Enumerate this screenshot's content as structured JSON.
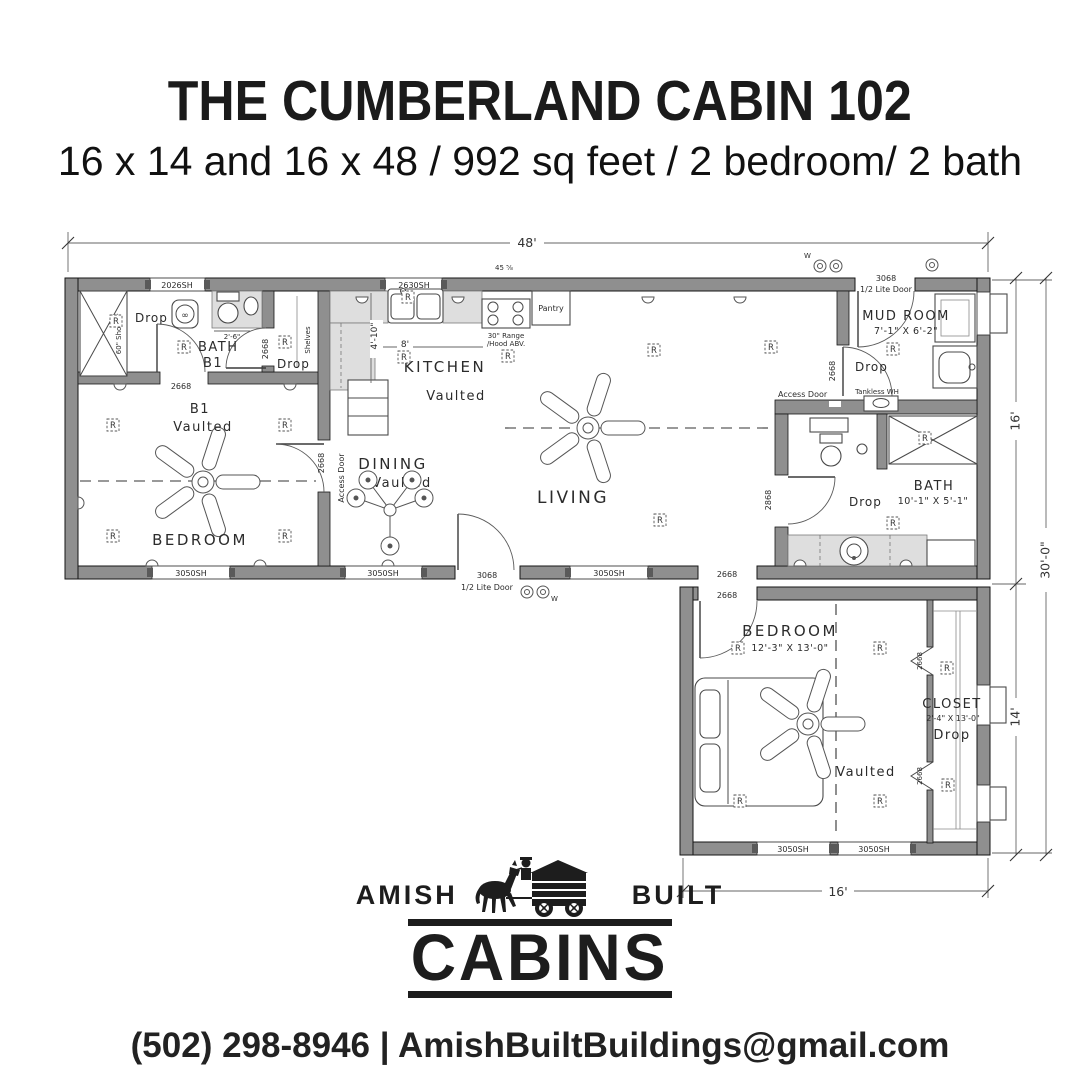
{
  "header": {
    "title": "THE CUMBERLAND CABIN 102",
    "subtitle": "16 x 14 and 16 x 48 / 992 sq feet / 2 bedroom/ 2 bath"
  },
  "logo": {
    "amish": "AMISH",
    "built": "BUILT",
    "cabins": "CABINS"
  },
  "footer": {
    "contact": "(502) 298-8946 | AmishBuiltBuildings@gmail.com"
  },
  "plan": {
    "dims": {
      "top": "48'",
      "right_upper": "16'",
      "right_overall": "30'-0\"",
      "right_lower": "14'",
      "bottom": "16'",
      "kitchen_width": "8'",
      "kitchen_depth": "4'-10\"",
      "bath1_vanity": "2'-6\"",
      "tiny": "45 ⅝"
    },
    "rooms": {
      "bath1": "BATH",
      "bath1_sub": "B1",
      "bed1": "B1",
      "bed1_sub": "Vaulted",
      "bed1_name": "BEDROOM",
      "kitchen": "KITCHEN",
      "kitchen_sub": "Vaulted",
      "dining": "DINING",
      "dining_sub": "Vaulted",
      "living": "LIVING",
      "mudroom": "MUD ROOM",
      "mudroom_size": "7'-1\" X 6'-2\"",
      "bath2": "BATH",
      "bath2_size": "10'-1\" X 5'-1\"",
      "bed2": "BEDROOM",
      "bed2_size": "12'-3\" X 13'-0\"",
      "bed2_sub": "Vaulted",
      "closet": "CLOSET",
      "closet_size": "2'-4\" X 13'-0\"",
      "closet_sub": "Drop"
    },
    "labels": {
      "drop": "Drop",
      "r": "R",
      "w": "W",
      "win_2026": "2026SH",
      "win_2630": "2630SH",
      "win_3050": "3050SH",
      "door_3068": "3068",
      "half_lite": "1/2 Lite Door",
      "door_2668": "2668",
      "door_2868": "2868",
      "access_door": "Access Door",
      "range": "30\" Range",
      "hood": "/Hood ABV.",
      "pantry": "Pantry",
      "tankless": "Tankless WH",
      "shower": "60\" Shower",
      "shelves": "Shelves"
    }
  }
}
